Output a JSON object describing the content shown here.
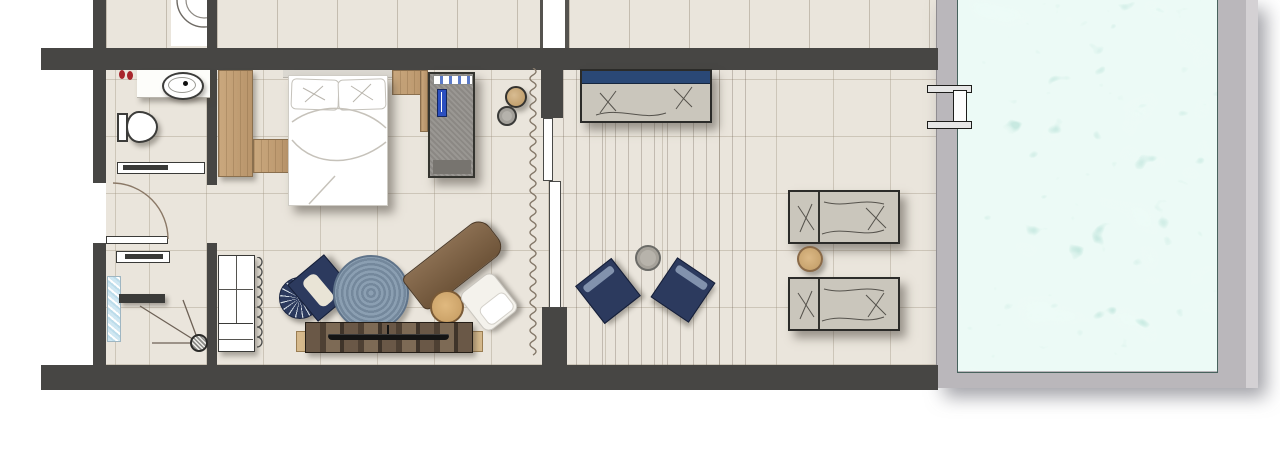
{
  "title": "hotel-suite-floor-plan-with-private-pool",
  "canvas": {
    "width": 1280,
    "height": 460
  },
  "colors": {
    "wall": "#474644",
    "tile": "#eae5dc",
    "deck": "#bab7bb",
    "deck-light": "#d4d1d4",
    "water": "#c9eee4",
    "navy": "#2c3a5e",
    "bolster-blue": "#2a4876",
    "wood": "#c6a67a",
    "wood-dark": "#7c6148",
    "cabinet-gray": "#94918c",
    "cushion": "#cac6bc",
    "red": "#a8262c",
    "denim": "#8195a8",
    "rustic": "#5c4c3c",
    "glass-blue": "#bcdcea"
  },
  "rooms": [
    {
      "name": "bathroom"
    },
    {
      "name": "entry-vestibule"
    },
    {
      "name": "shower-room"
    },
    {
      "name": "bedroom"
    },
    {
      "name": "terrace"
    },
    {
      "name": "private-pool"
    }
  ],
  "inventory": [
    "vanity-counter",
    "wash-basin",
    "toilet",
    "toiletry-bottles",
    "sliding-door-bathroom",
    "entry-door-swing",
    "shower-drain",
    "shower-bench",
    "glazed-window-strip",
    "sliding-door-shower",
    "open-wardrobe",
    "hanger-scallops",
    "double-bed",
    "pillows",
    "headboard-panel",
    "wood-side-panels",
    "tall-gray-cabinet",
    "towel-stack",
    "round-stools",
    "sheer-curtain",
    "sliding-glass-door",
    "fan-back-armchair",
    "round-jute-rug",
    "wooden-chaise-lounge",
    "tv-sideboard",
    "television",
    "outdoor-daybed",
    "lounge-chairs",
    "side-tables",
    "sun-loungers",
    "pool-ladder",
    "pool-water",
    "pool-deck"
  ]
}
